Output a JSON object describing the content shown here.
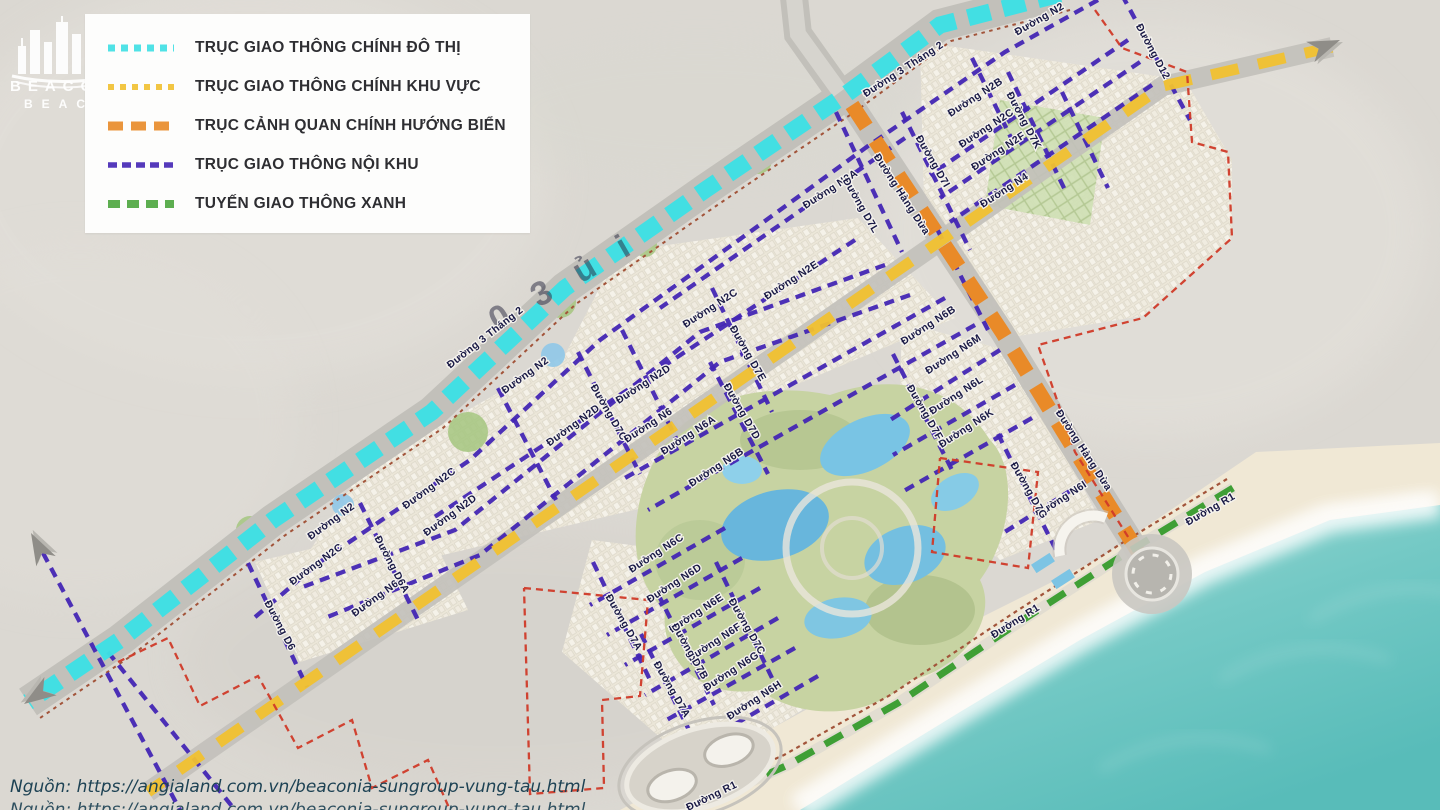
{
  "legend": {
    "items": [
      {
        "label": "TRỤC GIAO THÔNG CHÍNH ĐÔ THỊ",
        "color": "#3ee0e4",
        "dash": "7 6",
        "weight": 7
      },
      {
        "label": "TRỤC GIAO THÔNG CHÍNH KHU VỰC",
        "color": "#f1c12f",
        "dash": "6 6",
        "weight": 6
      },
      {
        "label": "TRỤC CẢNH QUAN CHÍNH HƯỚNG BIỂN",
        "color": "#e98a28",
        "dash": "15 8",
        "weight": 9
      },
      {
        "label": "TRỤC GIAO THÔNG NỘI KHU",
        "color": "#4326b4",
        "dash": "9 5",
        "weight": 5.5
      },
      {
        "label": "TUYẾN GIAO THÔNG XANH",
        "color": "#4ca63e",
        "dash": "12 7",
        "weight": 8
      }
    ]
  },
  "watermark": {
    "line1": "BEACONIA",
    "line2": "BEACH"
  },
  "source": {
    "line1": "Nguồn: https://angialand.com.vn/beaconia-sungroup-vung-tau.html",
    "line2": "Nguồn: https://angialand.com.vn/beaconia-sungroup-vung-tau.html"
  },
  "map": {
    "overlay_glyphs": "0 3 ủ i",
    "colors": {
      "land": "#dbd8d2",
      "road_base": "#c2c0ba",
      "cyan": "#3ee0e4",
      "yellow": "#f1c12f",
      "orange": "#e98a28",
      "purple": "#4326b4",
      "green": "#3f9f35",
      "red_boundary": "#d03a28",
      "brown_edge": "#a2543a",
      "sand": "#f0e8d5",
      "ocean": "#6ec7c3",
      "park": "#c7d3a2",
      "lagoon": "#6fbede",
      "label_ink": "#191945"
    },
    "labels": [
      {
        "t": "Đường 3 Tháng 2",
        "x": 905,
        "y": 72,
        "r": -33
      },
      {
        "t": "Đường 3 Tháng 2",
        "x": 487,
        "y": 340,
        "r": -38
      },
      {
        "t": "Đường N2",
        "x": 1041,
        "y": 22,
        "r": -30
      },
      {
        "t": "Đường N2",
        "x": 527,
        "y": 378,
        "r": -36
      },
      {
        "t": "Đường N2",
        "x": 333,
        "y": 524,
        "r": -36
      },
      {
        "t": "Đường N2A",
        "x": 832,
        "y": 192,
        "r": -33
      },
      {
        "t": "Đường N2B",
        "x": 977,
        "y": 100,
        "r": -33
      },
      {
        "t": "Đường N2C",
        "x": 988,
        "y": 131,
        "r": -33
      },
      {
        "t": "Đường N2F",
        "x": 1000,
        "y": 154,
        "r": -33
      },
      {
        "t": "Đường N4",
        "x": 1006,
        "y": 193,
        "r": -33
      },
      {
        "t": "Đường D7K",
        "x": 1021,
        "y": 122,
        "r": 62
      },
      {
        "t": "Đường D12",
        "x": 1150,
        "y": 53,
        "r": 62
      },
      {
        "t": "Đường N2E",
        "x": 793,
        "y": 283,
        "r": -33
      },
      {
        "t": "Đường N2C",
        "x": 712,
        "y": 311,
        "r": -33
      },
      {
        "t": "Đường N2D",
        "x": 645,
        "y": 387,
        "r": -33
      },
      {
        "t": "Đường N2D",
        "x": 575,
        "y": 428,
        "r": -36
      },
      {
        "t": "Đường D7C",
        "x": 606,
        "y": 414,
        "r": 60
      },
      {
        "t": "Đường D7E",
        "x": 745,
        "y": 355,
        "r": 60
      },
      {
        "t": "Đường D7D",
        "x": 739,
        "y": 413,
        "r": 60
      },
      {
        "t": "Đường D7L",
        "x": 858,
        "y": 207,
        "r": 60
      },
      {
        "t": "Đường D7I",
        "x": 930,
        "y": 163,
        "r": 60
      },
      {
        "t": "Đường Hàng Dừa",
        "x": 899,
        "y": 196,
        "r": 57
      },
      {
        "t": "Đường Hàng Dừa",
        "x": 1081,
        "y": 452,
        "r": 57
      },
      {
        "t": "Đường N6",
        "x": 650,
        "y": 428,
        "r": -33
      },
      {
        "t": "Đường N6",
        "x": 377,
        "y": 601,
        "r": -36
      },
      {
        "t": "Đường N6A",
        "x": 690,
        "y": 438,
        "r": -33
      },
      {
        "t": "Đường N6B",
        "x": 718,
        "y": 470,
        "r": -33
      },
      {
        "t": "Đường N6B",
        "x": 930,
        "y": 328,
        "r": -33
      },
      {
        "t": "Đường N6M",
        "x": 955,
        "y": 357,
        "r": -33
      },
      {
        "t": "Đường N6L",
        "x": 958,
        "y": 398,
        "r": -33
      },
      {
        "t": "Đường N6K",
        "x": 968,
        "y": 431,
        "r": -33
      },
      {
        "t": "Đường N6I",
        "x": 1063,
        "y": 502,
        "r": -33
      },
      {
        "t": "Đường D7G",
        "x": 1026,
        "y": 492,
        "r": 60
      },
      {
        "t": "Đường D7F",
        "x": 922,
        "y": 414,
        "r": 60
      },
      {
        "t": "Đường N6C",
        "x": 658,
        "y": 556,
        "r": -33
      },
      {
        "t": "Đường N6D",
        "x": 676,
        "y": 586,
        "r": -33
      },
      {
        "t": "Đường N6E",
        "x": 698,
        "y": 616,
        "r": -33
      },
      {
        "t": "Đường N6F",
        "x": 716,
        "y": 645,
        "r": -33
      },
      {
        "t": "Đường N6G",
        "x": 733,
        "y": 674,
        "r": -33
      },
      {
        "t": "Đường N6H",
        "x": 756,
        "y": 703,
        "r": -33
      },
      {
        "t": "Đường D7A",
        "x": 621,
        "y": 624,
        "r": 60
      },
      {
        "t": "Đường D7A",
        "x": 669,
        "y": 691,
        "r": 60
      },
      {
        "t": "Đường D7B",
        "x": 687,
        "y": 653,
        "r": 60
      },
      {
        "t": "Đường D7C",
        "x": 744,
        "y": 628,
        "r": 60
      },
      {
        "t": "Đường N2C",
        "x": 318,
        "y": 567,
        "r": -36
      },
      {
        "t": "Đường N2C",
        "x": 431,
        "y": 491,
        "r": -36
      },
      {
        "t": "Đường N2D",
        "x": 452,
        "y": 518,
        "r": -36
      },
      {
        "t": "Đường D6A",
        "x": 389,
        "y": 566,
        "r": 62
      },
      {
        "t": "Đường D6",
        "x": 277,
        "y": 627,
        "r": 62
      },
      {
        "t": "Đường R1",
        "x": 1212,
        "y": 512,
        "r": -30
      },
      {
        "t": "Đường R1",
        "x": 1017,
        "y": 624,
        "r": -32
      },
      {
        "t": "Đường R1",
        "x": 713,
        "y": 799,
        "r": -26
      }
    ]
  }
}
